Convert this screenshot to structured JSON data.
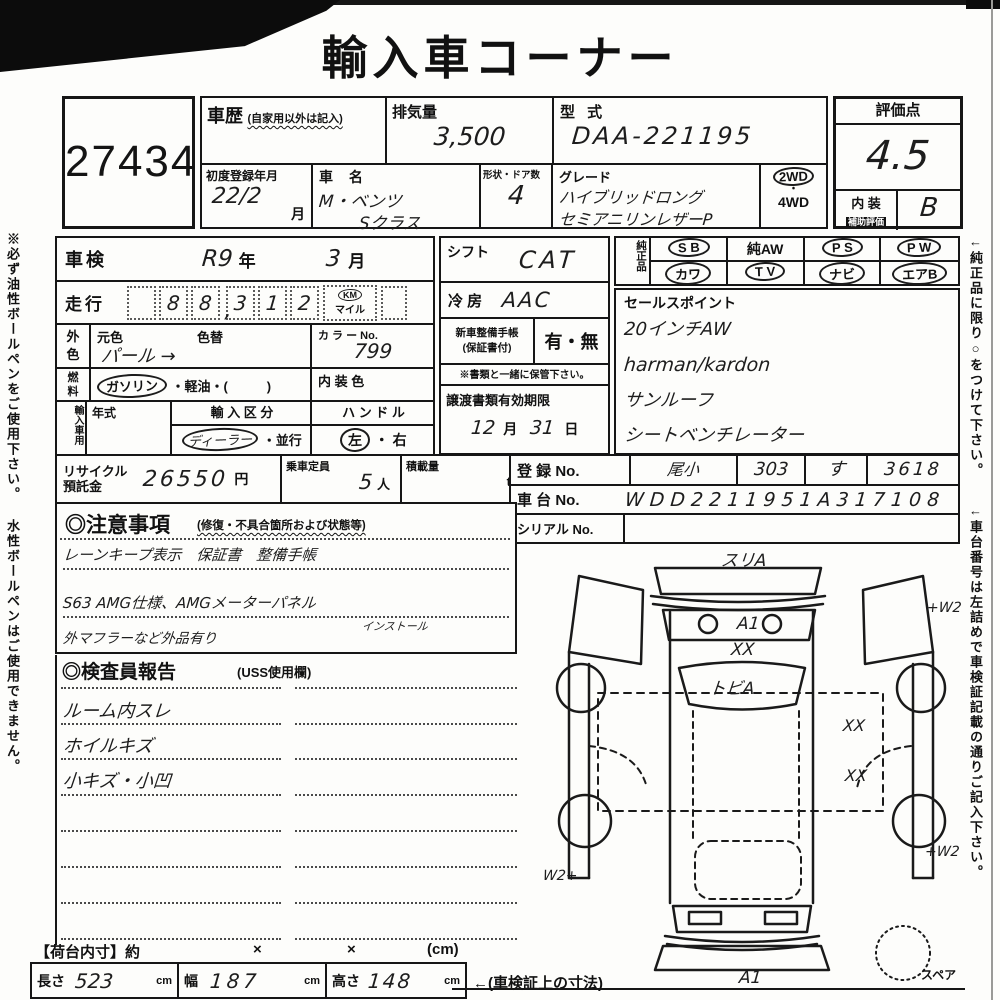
{
  "page": {
    "title": "輸入車コーナー",
    "lot_no": "27434",
    "left_note": "※必ず油性ボールペンをご使用下さい。 水性ボールペンはご使用できません。",
    "right_note_1": "←純正品に限り○をつけて下さい。",
    "right_note_2": "←車台番号は左詰めで車検証記載の通りご記入下さい。"
  },
  "header": {
    "history_label": "車歴",
    "history_note": "(自家用以外は記入)",
    "displacement_label": "排気量",
    "displacement_value": "3,500",
    "model_label": "型 式",
    "model_value": "DAA-221195",
    "first_reg_label": "初度登録年月",
    "first_reg_value": "22/2",
    "first_reg_unit": "月",
    "name_label": "車 名",
    "name_value_1": "M・ベンツ",
    "name_value_2": "Sクラス",
    "shape_label": "形状・ドア数",
    "shape_value": "4",
    "grade_label": "グレード",
    "grade_value_1": "ハイブリッドロング",
    "grade_value_2": "セミアニリンレザーP",
    "drive_2wd": "2WD",
    "drive_dot": "・",
    "drive_4wd": "4WD",
    "score_label": "評価点",
    "score_value": "4.5",
    "interior_label_1": "内 装",
    "interior_label_2": "補助評価",
    "interior_value": "B"
  },
  "inspection": {
    "shaken_label": "車検",
    "shaken_year": "R9",
    "shaken_year_unit": "年",
    "shaken_month": "3",
    "shaken_month_unit": "月",
    "mileage_label": "走行",
    "mileage_digits": [
      "",
      "8",
      "8",
      "3",
      "1",
      "2"
    ],
    "mileage_comma": ",",
    "mileage_unit_top": "KM",
    "mileage_unit_bottom": "マイル",
    "color_label_1": "外",
    "color_label_2": "色",
    "orig_color_label": "元色",
    "color_change_label": "色替",
    "orig_color_value": "パール →",
    "color_no_label": "カ ラ ー No.",
    "color_no_value": "799",
    "fuel_label_1": "燃",
    "fuel_label_2": "料",
    "fuel_opt_circled": "ガソリン",
    "fuel_opt_rest": "・軽油・(　　　)",
    "interior_color_label": "内 装 色",
    "import_label": "輸入車用",
    "model_year_label": "年式",
    "import_class_label": "輸 入 区 分",
    "import_class_circled": "ディーラー",
    "import_class_rest": "・並行",
    "handle_label": "ハ ン ド ル",
    "handle_circled": "左",
    "handle_rest": "・ 右"
  },
  "middle": {
    "shift_label": "シフト",
    "shift_value": "CAT",
    "ac_label": "冷 房",
    "ac_value": "AAC",
    "book_label_1": "新車整備手帳",
    "book_label_2": "(保証書付)",
    "book_options": "有・無",
    "keep_note": "※書類と一緒に保管下さい。",
    "transfer_label": "譲渡書類有効期限",
    "transfer_month": "12",
    "transfer_month_unit": "月",
    "transfer_day": "31",
    "transfer_day_unit": "日"
  },
  "genuine": {
    "label": "純正品",
    "row1": [
      "S B",
      "純AW",
      "P S",
      "P W"
    ],
    "row2": [
      "カワ",
      "T V",
      "ナビ",
      "エアB"
    ]
  },
  "sales": {
    "label": "セールスポイント",
    "line1": "20インチAW",
    "line2": "harman/kardon",
    "line3": "サンルーフ",
    "line4": "シートベンチレーター"
  },
  "registration": {
    "reg_label": "登 録 No.",
    "reg_values": [
      "尾小",
      "303",
      "す",
      "3618"
    ],
    "chassis_label": "車 台 No.",
    "chassis_value": "WDD2211951A317108",
    "serial_label": "シリアル No."
  },
  "recycle": {
    "label_1": "リサイクル",
    "label_2": "預託金",
    "value": "26550",
    "yen": "円",
    "capacity_label": "乗車定員",
    "capacity_value": "5",
    "capacity_unit": "人",
    "load_label": "積載量",
    "load_unit": "t"
  },
  "notes": {
    "heading": "◎注意事項",
    "heading_note": "(修復・不具合箇所および状態等)",
    "line1": "レーンキープ表示　保証書　整備手帳",
    "line2": "S63 AMG仕様、AMGメーターパネル",
    "line2_sub": "インストール",
    "line3": "外マフラーなど外品有り"
  },
  "inspector": {
    "heading": "◎検査員報告",
    "heading_note": "(USS使用欄)",
    "line1": "ルーム内スレ",
    "line2": "ホイルキズ",
    "line3": "小キズ・小凹"
  },
  "dimensions": {
    "heading": "【荷台内寸】約",
    "x1": "×",
    "x2": "×",
    "cm_note": "(cm)",
    "length_label": "長さ",
    "length_value": "523",
    "width_label": "幅",
    "width_value": "187",
    "height_label": "高さ",
    "height_value": "148",
    "unit": "cm",
    "ref_note": "←(車検証上の寸法)"
  },
  "diagram": {
    "front_note": "スリA",
    "hood_a": "A1",
    "hood_xx": "XX",
    "windshield_note": "トビA",
    "w2_front_right": "+W2",
    "xx_right_1": "XX",
    "xx_right_2": "XX",
    "w2_rear_left": "W2+",
    "w2_rear_right": "+W2",
    "rear_a": "A1",
    "spare_label": "スペア"
  }
}
